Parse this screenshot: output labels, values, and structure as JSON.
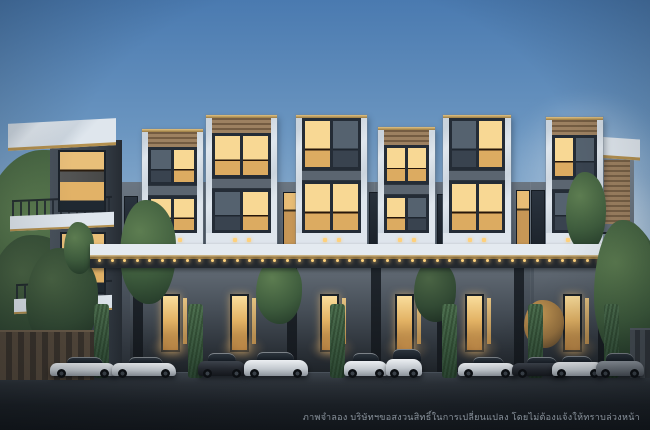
{
  "scene": {
    "description": "Dusk architectural rendering of a row of modern three-storey luxury townhomes with white marble and gold-trimmed facades, warm-lit windows, hedge columns, and luxury cars parked along the front driveway"
  },
  "disclaimer": {
    "text": "ภาพจำลอง บริษัทฯขอสงวนสิทธิ์ในการเปลี่ยนแปลง โดยไม่ต้องแจ้งให้ทราบล่วงหน้า"
  },
  "palette": {
    "sky_top": "#4a7ab0",
    "sky_mid": "#7aa0c6",
    "sky_low": "#b9cede",
    "marble": "#dfe6ed",
    "gold": "#b3904f",
    "gold_light": "#ffd27c",
    "wood": "#9d8161",
    "window_frame": "#242c36",
    "glass_lit": "#f3c577",
    "glass_dark": "#3d4854",
    "facade": "#545e68",
    "facade_dark": "#2c323a",
    "hedge": "#3a5a3e",
    "tree_green": "#3e5c3d",
    "tree_warm": "#b08346",
    "road_top": "#3b424a",
    "road_bottom": "#12161b",
    "car_white": "#d3d8dd",
    "car_dark": "#23272e",
    "car_gray": "#717880"
  },
  "clouds": [
    {
      "left": 498,
      "top": 96,
      "w": 180,
      "h": 150,
      "op": 0.45
    },
    {
      "left": 540,
      "top": 170,
      "w": 140,
      "h": 130,
      "op": 0.6
    },
    {
      "left": 572,
      "top": 248,
      "w": 110,
      "h": 80,
      "op": 0.5
    },
    {
      "left": -35,
      "top": 210,
      "w": 130,
      "h": 70,
      "op": 0.3
    }
  ],
  "bg_trees": [
    {
      "left": -25,
      "top": 150,
      "w": 150,
      "h": 215,
      "tone": "green",
      "z": 2
    },
    {
      "left": -12,
      "top": 235,
      "w": 95,
      "h": 125,
      "tone": "dark",
      "z": 2
    },
    {
      "left": 548,
      "top": 212,
      "w": 112,
      "h": 150,
      "tone": "green",
      "z": 2
    }
  ],
  "towers": [
    {
      "left": 142,
      "top": 129,
      "width": 61,
      "wood": true,
      "lit3": [
        0,
        1
      ],
      "lit2": [
        1,
        1
      ]
    },
    {
      "left": 206,
      "top": 115,
      "width": 71,
      "wood": true,
      "lit3": [
        1,
        1
      ],
      "lit2": [
        0,
        1
      ]
    },
    {
      "left": 296,
      "top": 115,
      "width": 71,
      "wood": false,
      "lit3": [
        1,
        0
      ],
      "lit2": [
        1,
        1
      ]
    },
    {
      "left": 378,
      "top": 127,
      "width": 57,
      "wood": true,
      "lit3": [
        1,
        1
      ],
      "lit2": [
        1,
        0
      ]
    },
    {
      "left": 443,
      "top": 115,
      "width": 68,
      "wood": false,
      "lit3": [
        0,
        1
      ],
      "lit2": [
        1,
        1
      ]
    },
    {
      "left": 546,
      "top": 117,
      "width": 57,
      "wood": true,
      "lit3": [
        1,
        0
      ],
      "lit2": [
        0,
        1
      ]
    }
  ],
  "gap_windows": [
    {
      "left": 124,
      "width": 12,
      "top": 196,
      "height": 50,
      "lit": 0
    },
    {
      "left": 283,
      "width": 12,
      "top": 192,
      "height": 55,
      "lit": 1
    },
    {
      "left": 369,
      "width": 10,
      "top": 192,
      "height": 55,
      "lit": 0
    },
    {
      "left": 437,
      "width": 9,
      "top": 194,
      "height": 52,
      "lit": 0
    },
    {
      "left": 516,
      "width": 12,
      "top": 190,
      "height": 58,
      "lit": 1
    },
    {
      "left": 531,
      "width": 12,
      "top": 190,
      "height": 58,
      "lit": 0
    }
  ],
  "pillars": [
    133,
    287,
    371,
    437,
    514,
    598
  ],
  "hedges": [
    94,
    188,
    330,
    442,
    528,
    604
  ],
  "front_trees": [
    {
      "left": 26,
      "top": 248,
      "w": 72,
      "h": 104,
      "tone": "dark",
      "z": 5
    },
    {
      "left": 120,
      "top": 200,
      "w": 56,
      "h": 104,
      "tone": "green",
      "z": 6
    },
    {
      "left": 64,
      "top": 222,
      "w": 30,
      "h": 52,
      "tone": "green",
      "z": 6
    },
    {
      "left": 256,
      "top": 258,
      "w": 46,
      "h": 66,
      "tone": "green",
      "z": 6
    },
    {
      "left": 414,
      "top": 260,
      "w": 42,
      "h": 62,
      "tone": "dark",
      "z": 6
    },
    {
      "left": 566,
      "top": 172,
      "w": 40,
      "h": 80,
      "tone": "green",
      "z": 6
    },
    {
      "left": 594,
      "top": 220,
      "w": 62,
      "h": 142,
      "tone": "green",
      "z": 8
    },
    {
      "left": 524,
      "top": 300,
      "w": 40,
      "h": 48,
      "tone": "warm",
      "z": 8
    }
  ],
  "cars": [
    {
      "left": 50,
      "w": 66,
      "type": "sports",
      "color": "white"
    },
    {
      "left": 112,
      "w": 64,
      "type": "sports",
      "color": "white"
    },
    {
      "left": 198,
      "w": 48,
      "type": "sedan",
      "color": "dark"
    },
    {
      "left": 244,
      "w": 64,
      "type": "luxury",
      "color": "white"
    },
    {
      "left": 344,
      "w": 44,
      "type": "sedan",
      "color": "white"
    },
    {
      "left": 386,
      "w": 36,
      "type": "suv",
      "color": "white"
    },
    {
      "left": 458,
      "w": 58,
      "type": "sports",
      "color": "white"
    },
    {
      "left": 512,
      "w": 56,
      "type": "sports",
      "color": "dark"
    },
    {
      "left": 552,
      "w": 52,
      "type": "coupe",
      "color": "white"
    },
    {
      "left": 596,
      "w": 48,
      "type": "sedan",
      "color": "gray"
    }
  ]
}
